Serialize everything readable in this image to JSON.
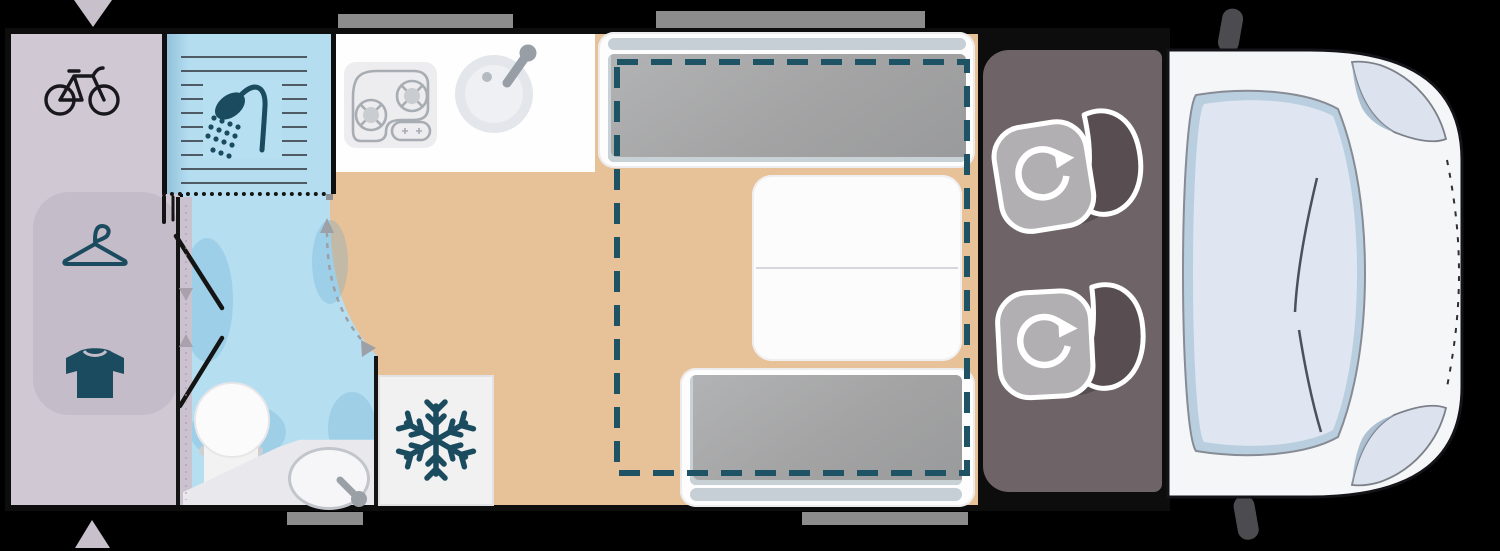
{
  "diagram": {
    "type": "campervan-floorplan",
    "view": "top-down",
    "text_labels": [],
    "features": [
      "rear-garage",
      "wardrobe",
      "shower",
      "bathroom",
      "toilet",
      "washbasin",
      "kitchen-counter",
      "hob",
      "kitchen-sink",
      "refrigerator",
      "rear-bench-bed",
      "dining-table",
      "front-bench-bed",
      "drop-down-bed-outline",
      "pivoting-wall-swing-path",
      "folding-door",
      "entry-door-markers",
      "windows",
      "cab",
      "swivel-seat-1",
      "swivel-seat-2",
      "windshield",
      "side-windows",
      "mirrors",
      "hood-line"
    ]
  },
  "icons": [
    "bicycle-icon",
    "hanger-icon",
    "tshirt-icon",
    "shower-icon",
    "snowflake-icon",
    "hob-icon",
    "sink-icon",
    "swivel-arrow-icon",
    "door-arrow-icon"
  ],
  "colors": {
    "background": "#000000",
    "wall": "#0d0d0d",
    "garage_floor": "#d0c9d4",
    "wardrobe": "#c4bcc8",
    "bathroom_floor": "#b5def1",
    "fixture_teal": "#1b4b5e",
    "icon_black": "#17171c",
    "wood_light": "#ecc9a1",
    "wood_dark": "#dcae80",
    "kitchen_counter": "#fefefe",
    "appliance_gray": "#a8acb3",
    "cushion_gray": "#a3a3a4",
    "headrest_slot": "#c6cfd5",
    "bed_outline_dash": "#1d5364",
    "swing_path_gray": "#9da0a6",
    "cab_floor": "#6e6467",
    "seat_cushion": "#b2afb2",
    "seat_back": "#584e52",
    "seat_outline": "#ffffff",
    "van_body": "#f5f6f8",
    "glass": "#dfe6f2",
    "glass_edge": "#b9cfe0",
    "mirror": "#4c4c50",
    "window_bar": "#8c8c8c",
    "door_arrow": "#c8c1cc",
    "counter": "#e9e9ed"
  }
}
